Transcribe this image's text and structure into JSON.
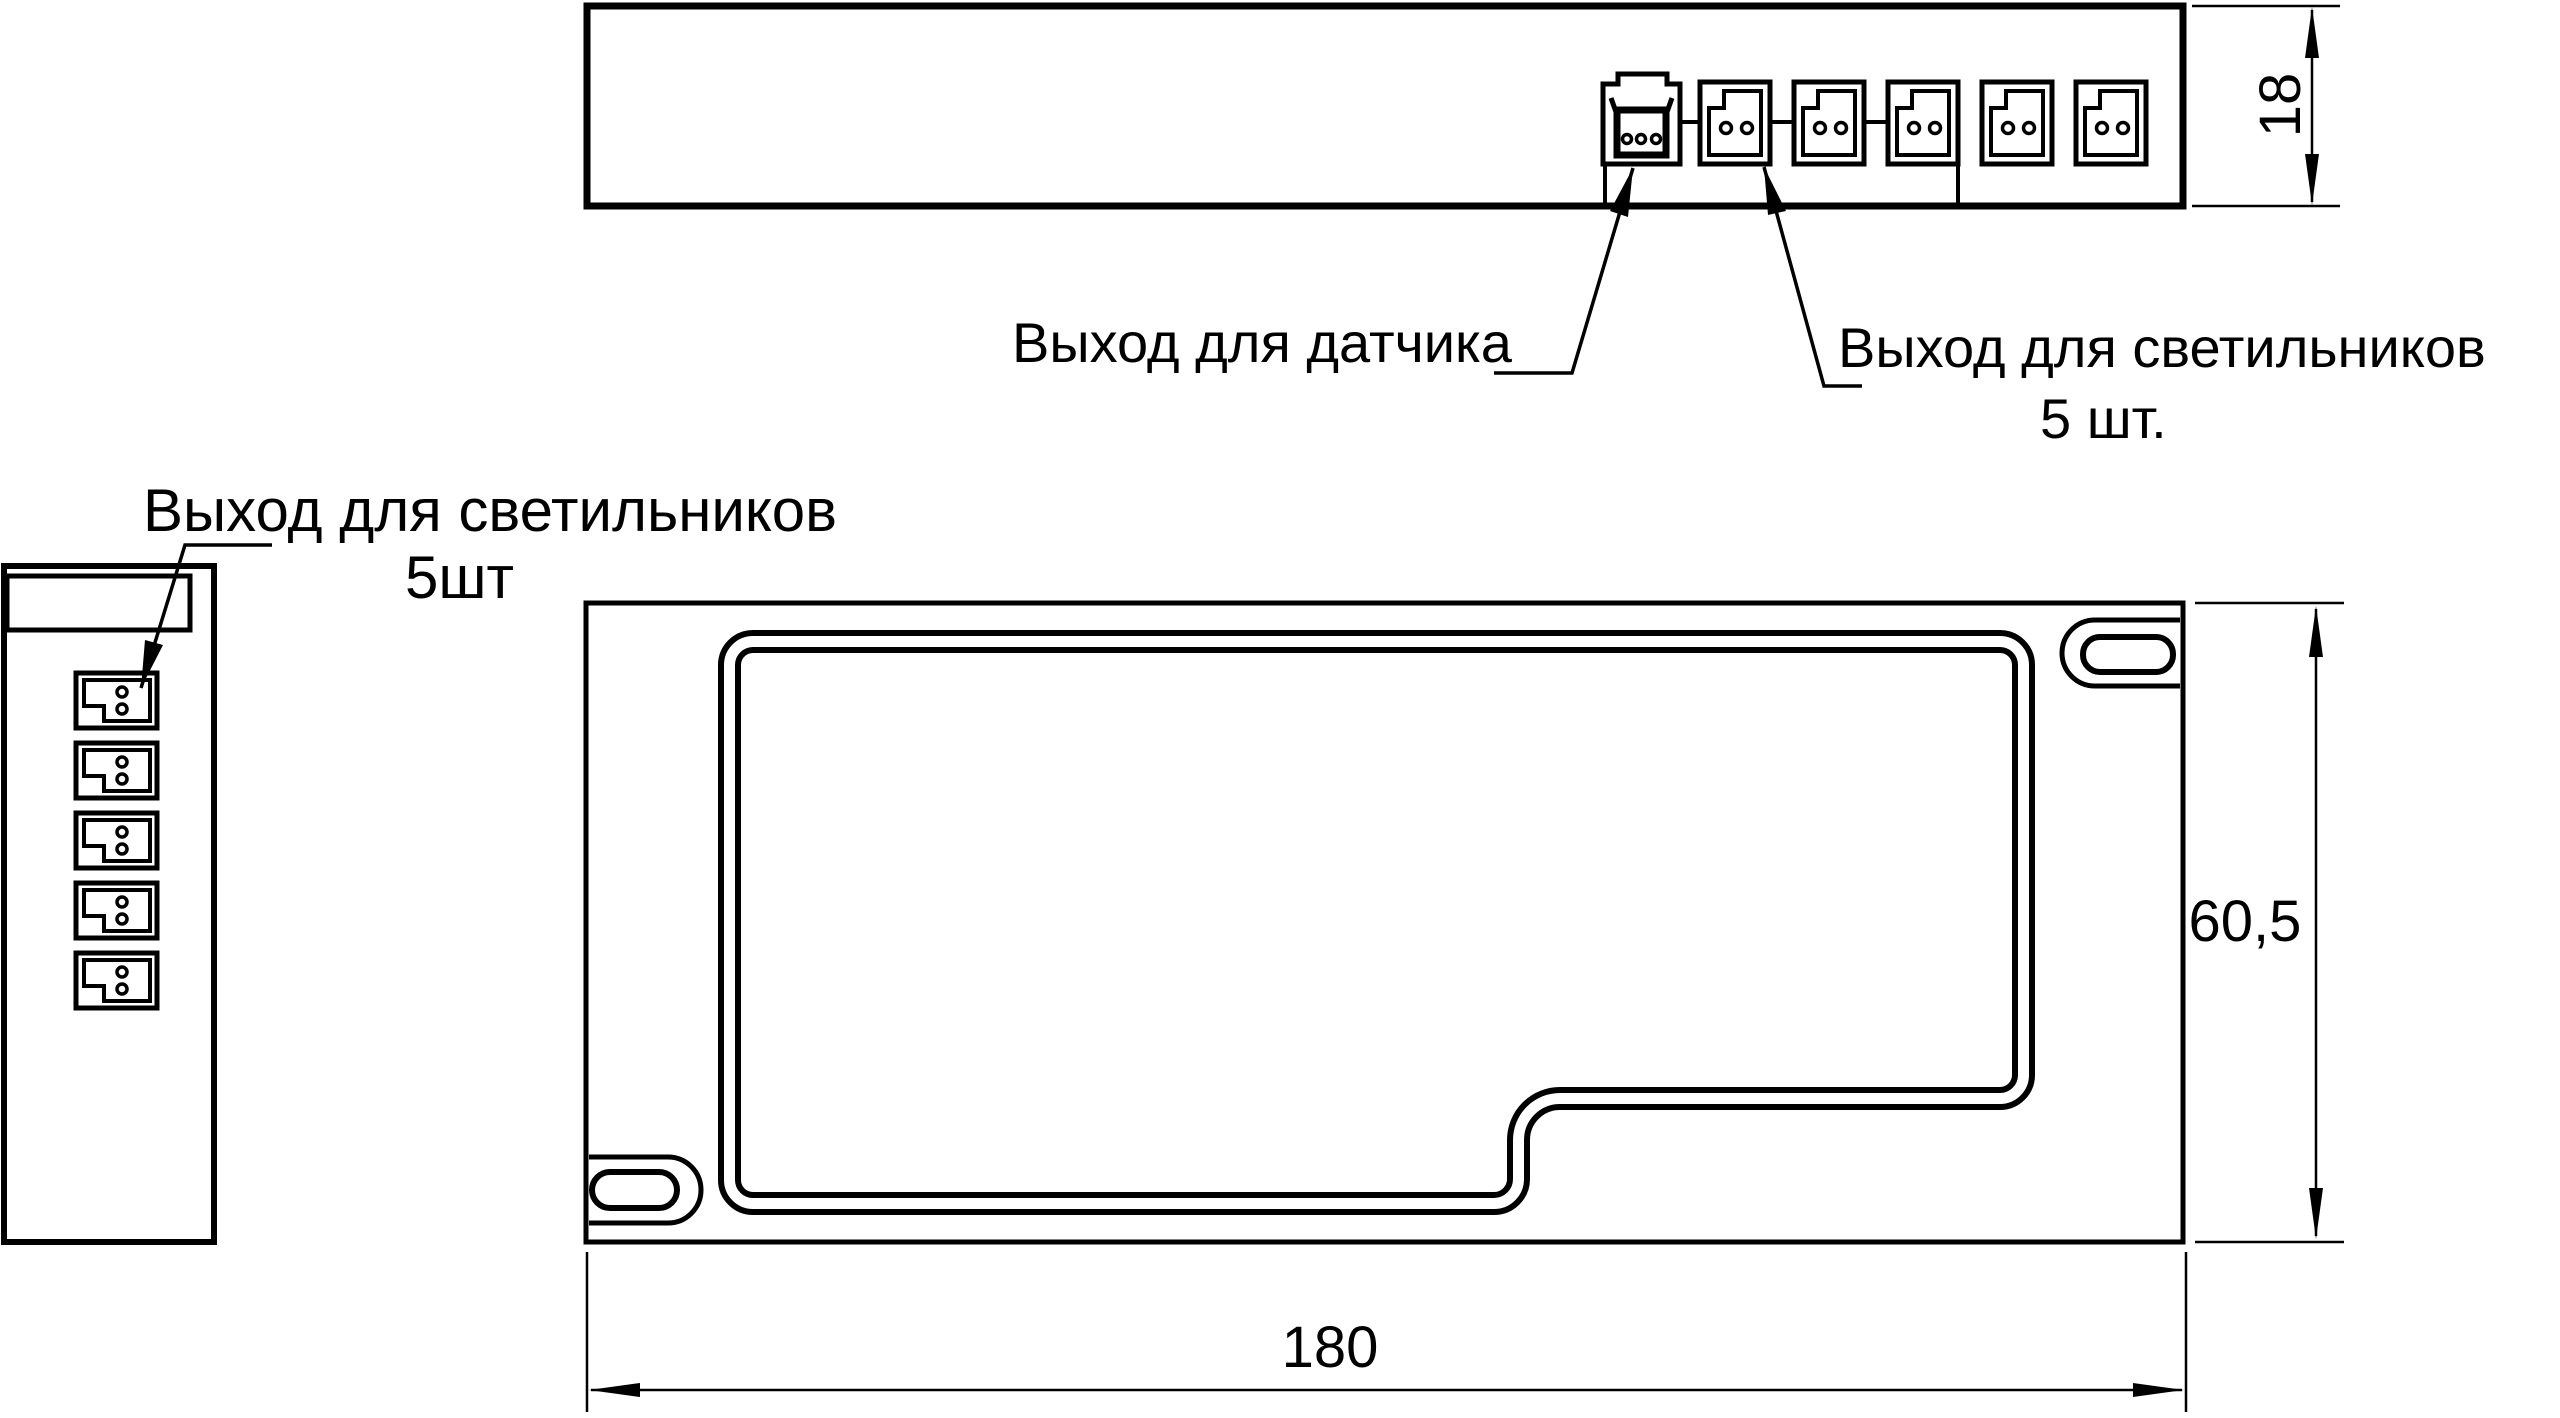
{
  "colors": {
    "background": "#ffffff",
    "line": "#000000"
  },
  "labels": {
    "sensor_output": "Выход для датчика",
    "luminaires_top": {
      "line1": "Выход для светильников",
      "line2": "5 шт."
    },
    "luminaires_side": {
      "line1": "Выход для светильников",
      "line2": "5шт"
    }
  },
  "dimensions": {
    "side_view_height": "18",
    "plan_view_height": "60,5",
    "plan_view_width": "180"
  }
}
